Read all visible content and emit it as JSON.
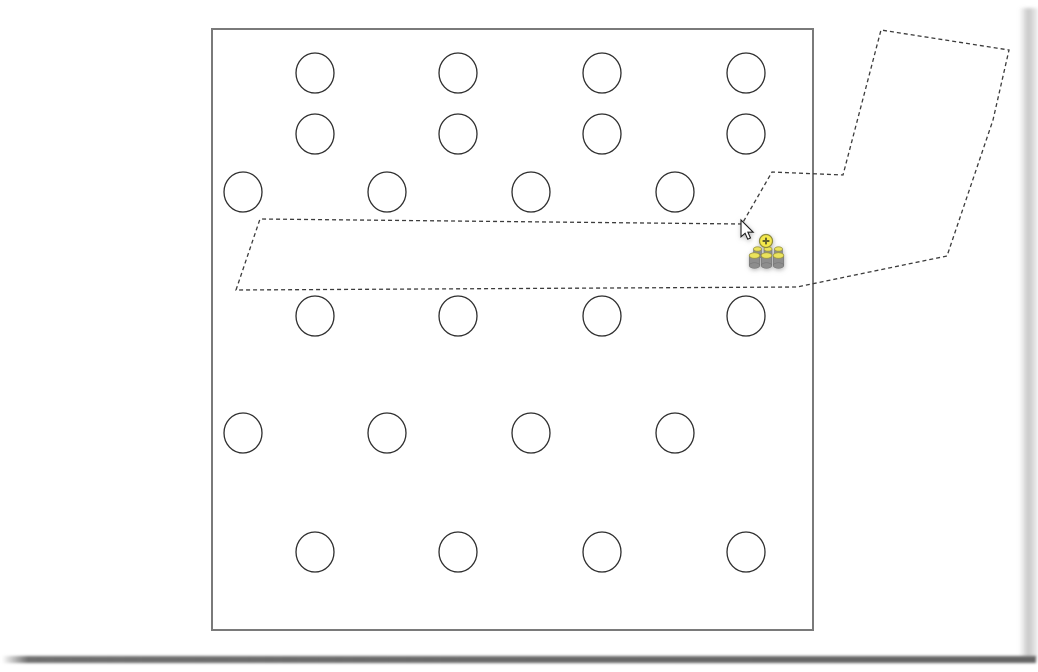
{
  "scene": {
    "background_color": "#ffffff",
    "frame": {
      "x": 212,
      "y": 29,
      "width": 601,
      "height": 601,
      "fill": "#ffffff",
      "border_color": "#7a7a7a",
      "border_width": 2
    },
    "circles": {
      "rx": 19,
      "ry": 20,
      "fill": "#ffffff",
      "stroke_color": "#2e2e2e",
      "stroke_width": 1.3,
      "rows": [
        {
          "y": 73,
          "xs": [
            315,
            458,
            602,
            746
          ]
        },
        {
          "y": 134,
          "xs": [
            315,
            458,
            602,
            746
          ]
        },
        {
          "y": 192,
          "xs": [
            243,
            387,
            531,
            675
          ]
        },
        {
          "y": 316,
          "xs": [
            315,
            458,
            602,
            746
          ]
        },
        {
          "y": 433,
          "xs": [
            243,
            387,
            531,
            675
          ]
        },
        {
          "y": 552,
          "xs": [
            315,
            458,
            602,
            746
          ]
        }
      ]
    },
    "drag_outline": {
      "stroke_color": "#3b3b3b",
      "stroke_width": 1.3,
      "dash_pattern": "4 3",
      "points": [
        [
          236,
          290
        ],
        [
          260,
          219
        ],
        [
          742,
          224
        ],
        [
          772,
          172
        ],
        [
          843,
          175
        ],
        [
          881,
          30
        ],
        [
          1009,
          50
        ],
        [
          993,
          120
        ],
        [
          947,
          256
        ],
        [
          797,
          287
        ]
      ]
    },
    "cursor": {
      "x": 741,
      "y": 220,
      "arrow_fill": "#ffffff",
      "arrow_stroke": "#1b1b1b",
      "halo_color": "#8f8f8f",
      "badge": {
        "dx": 25,
        "dy": 21,
        "radius": 6.5,
        "fill": "#f4e84b",
        "stroke": "#8f8c3a",
        "glyph": "plus",
        "glyph_color": "#60602e"
      },
      "payload": {
        "body_color": "#8d8d8d",
        "body_edge_color": "#767676",
        "top_color": "#ebe35b",
        "top_stroke": "#a09a42",
        "back_row": {
          "cy": 249,
          "cxs": [
            757.5,
            768,
            778.5
          ],
          "w": 8,
          "h": 7,
          "ery": 2.2
        },
        "front_row": {
          "cy": 255.5,
          "cxs": [
            754.5,
            766.5,
            778.5
          ],
          "w": 10.5,
          "h": 10,
          "ery": 2.8
        }
      }
    }
  }
}
